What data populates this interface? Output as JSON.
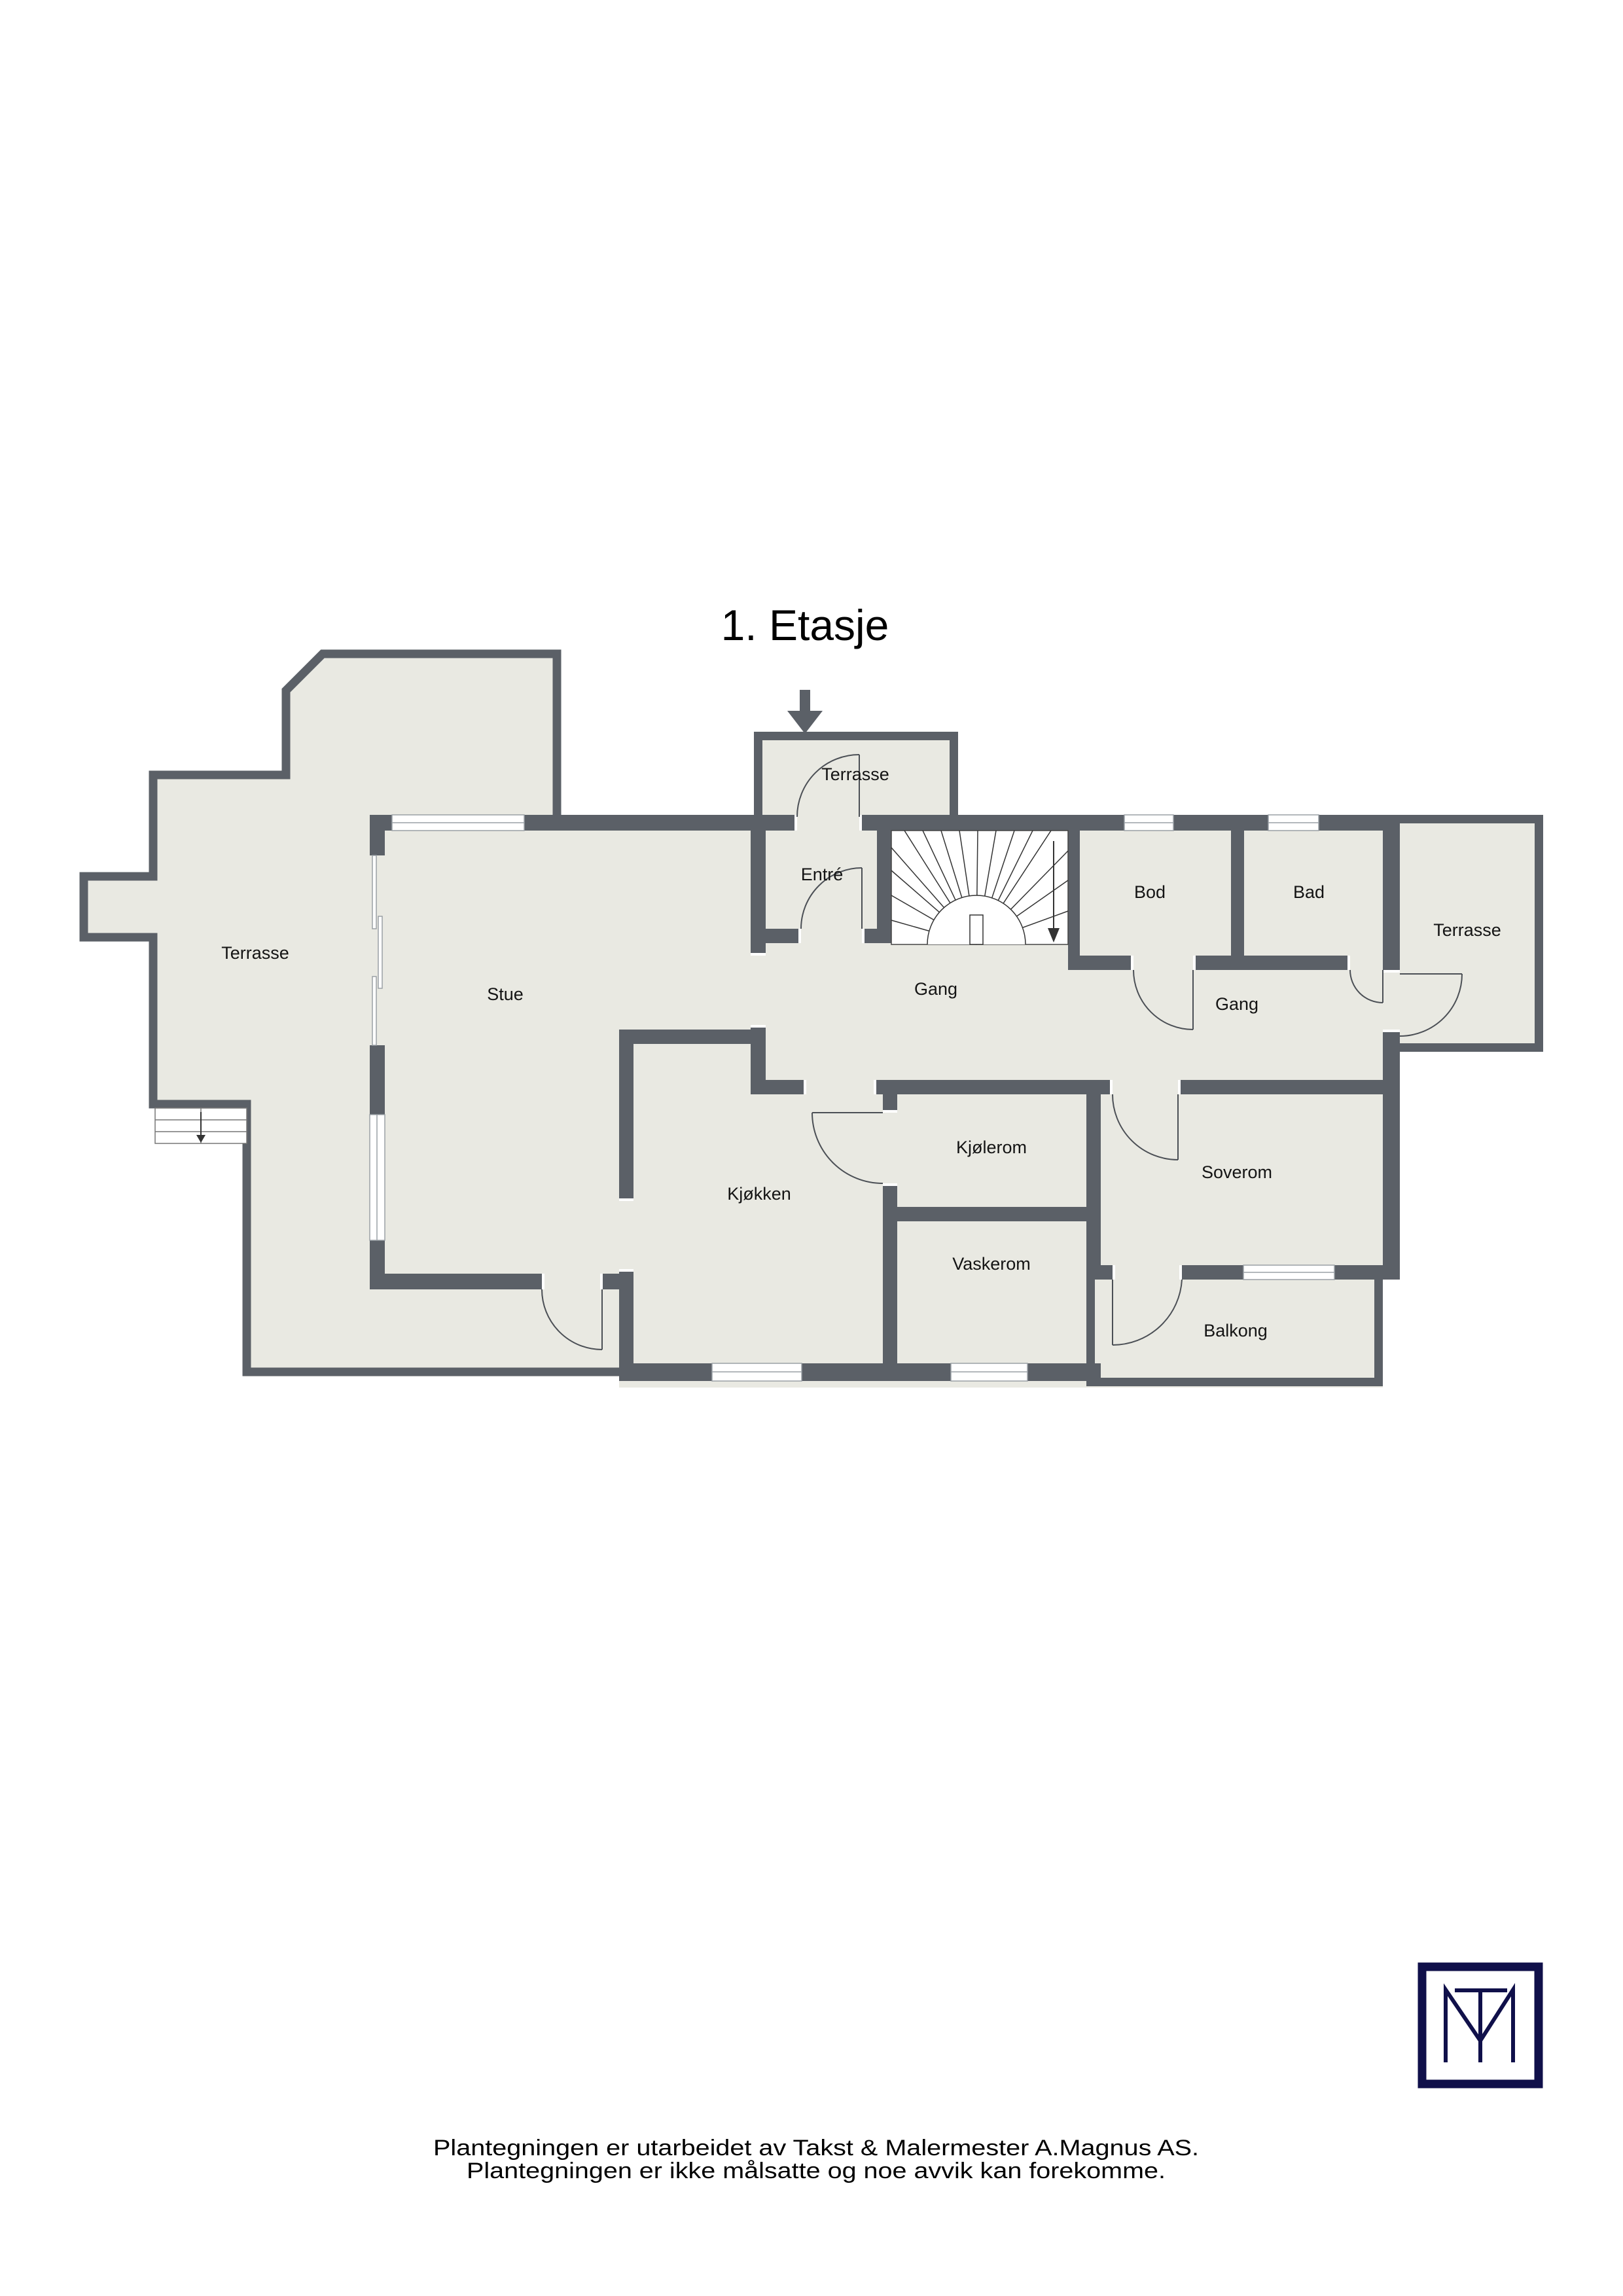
{
  "title": "1. Etasje",
  "rooms": {
    "terrasse_left": {
      "label": "Terrasse"
    },
    "stue": {
      "label": "Stue"
    },
    "terrasse_top": {
      "label": "Terrasse"
    },
    "entre": {
      "label": "Entré"
    },
    "gang_mid": {
      "label": "Gang"
    },
    "bod": {
      "label": "Bod"
    },
    "bad": {
      "label": "Bad"
    },
    "terrasse_right": {
      "label": "Terrasse"
    },
    "gang_right": {
      "label": "Gang"
    },
    "kjolerom": {
      "label": "Kjølerom"
    },
    "kjokken": {
      "label": "Kjøkken"
    },
    "vaskerom": {
      "label": "Vaskerom"
    },
    "soverom": {
      "label": "Soverom"
    },
    "balkong": {
      "label": "Balkong"
    }
  },
  "icons": {
    "entry_arrow": "down-arrow",
    "stairs_down_arrow": "down-arrow",
    "steps_down_arrow": "down-arrow"
  },
  "logo": {
    "monogram": "TM"
  },
  "footer": {
    "line1": "Plantegningen er utarbeidet av Takst & Malermester A.Magnus AS.",
    "line2": "Plantegningen er ikke målsatte og noe avvik kan forekomme."
  },
  "colors": {
    "wall": "#5b6067",
    "floor": "#e9e9e2",
    "window": "#ffffff",
    "accent_navy": "#10104a"
  }
}
